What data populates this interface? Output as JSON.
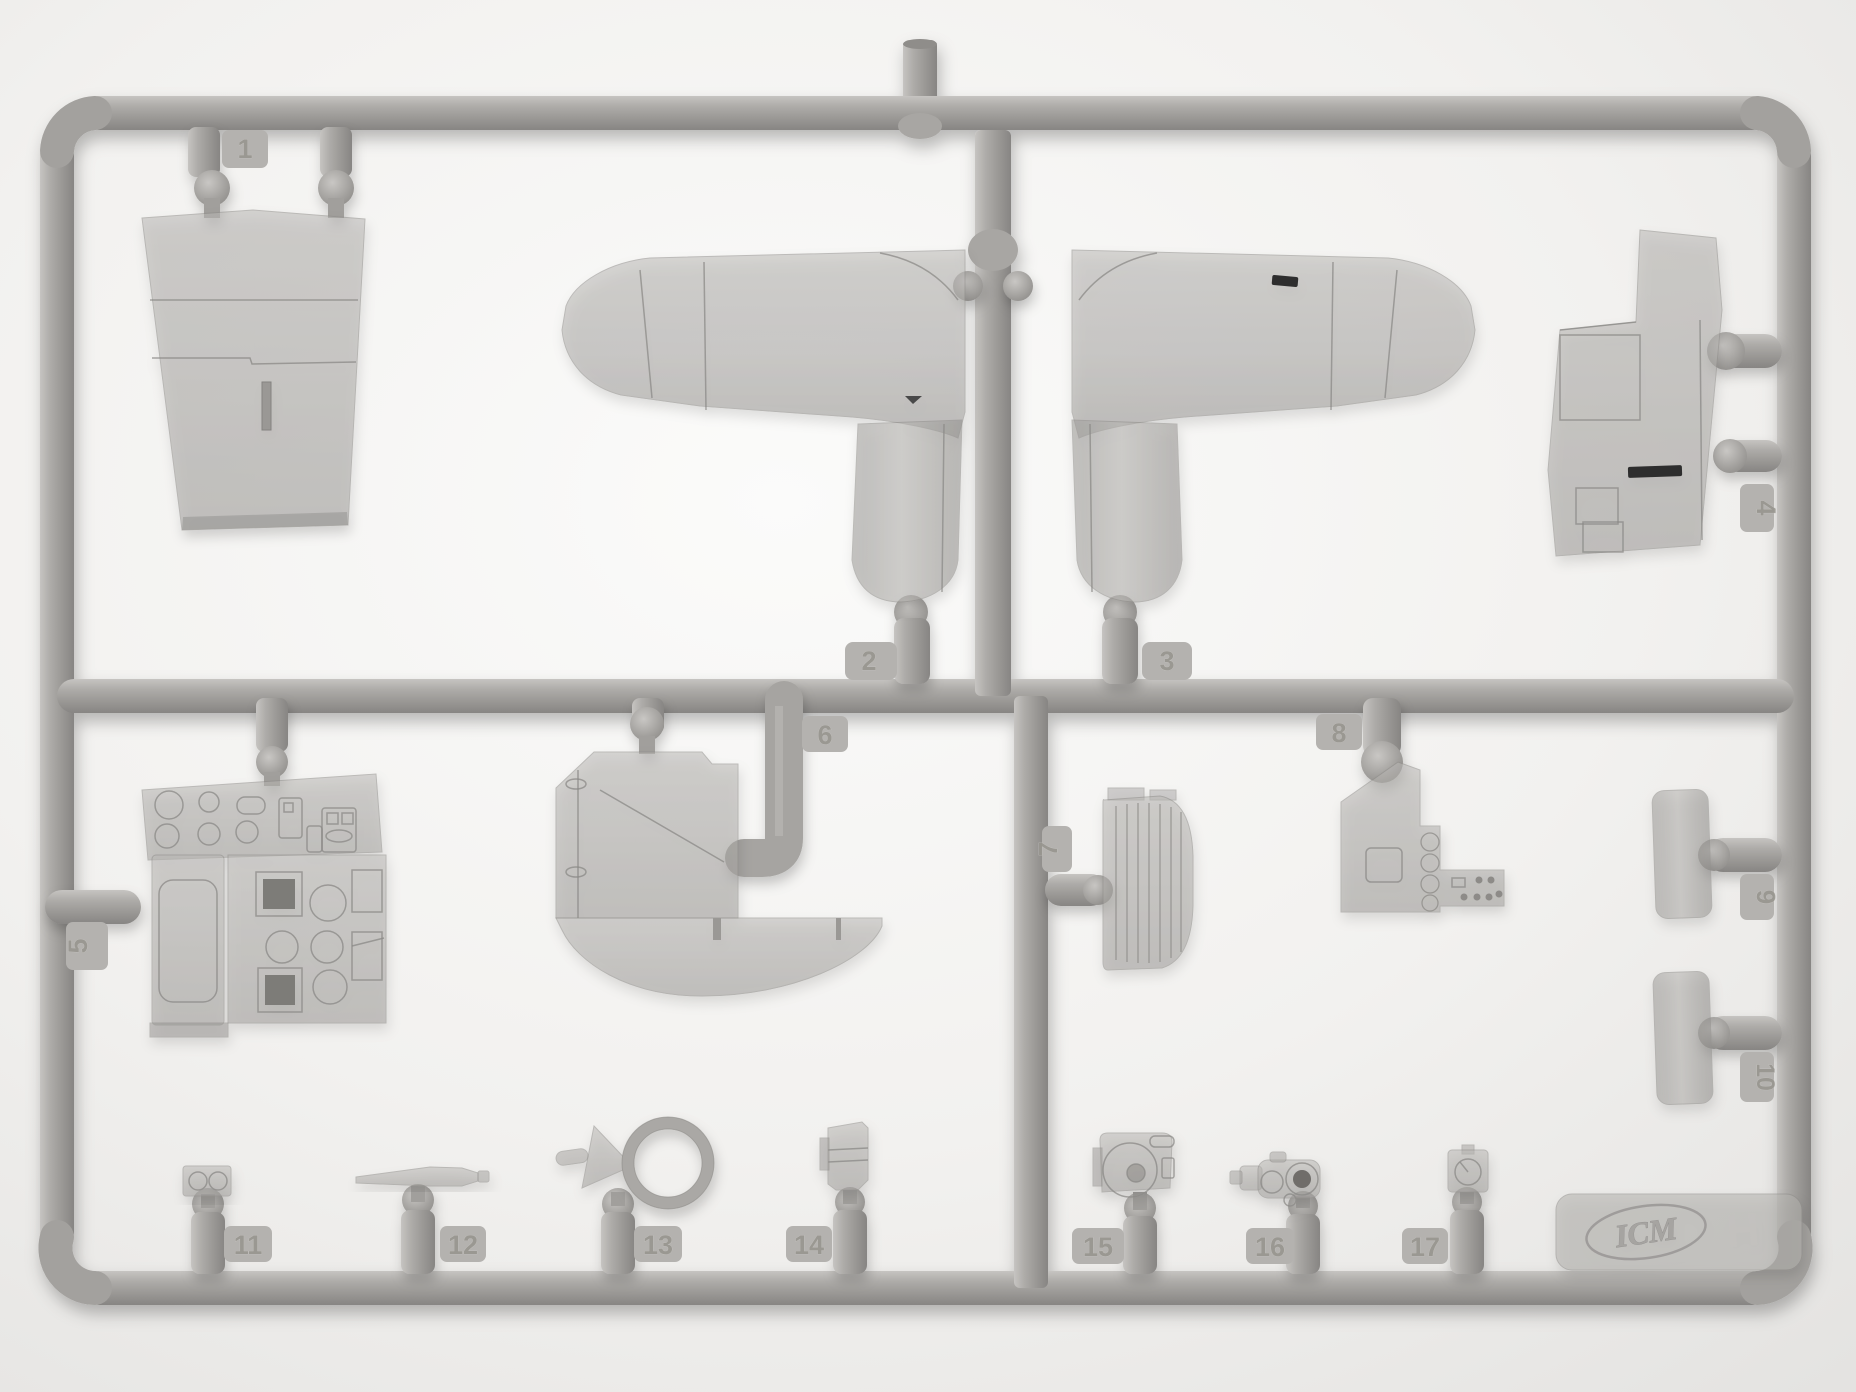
{
  "scene": {
    "description_colors": {
      "background": "#eeedeb",
      "plastic": "#aaa8a5",
      "plastic_highlight": "#c6c4c1",
      "plastic_shadow": "#8a8885",
      "dark_slot": "#2f2f2f"
    }
  },
  "sprue": {
    "part_count": 17,
    "tags": [
      "1",
      "2",
      "3",
      "4",
      "5",
      "6",
      "7",
      "8",
      "9",
      "10",
      "11",
      "12",
      "13",
      "14",
      "15",
      "16",
      "17"
    ],
    "logo_text": "ICM",
    "mold_letter": "H",
    "parts": [
      {
        "number": "1",
        "name": "tapered-fuselage-panel"
      },
      {
        "number": "2",
        "name": "wing-half-left-with-wheel-well"
      },
      {
        "number": "3",
        "name": "wing-half-right-with-wheel-well"
      },
      {
        "number": "4",
        "name": "stepped-fuselage-side-panel"
      },
      {
        "number": "5",
        "name": "instrument-panel-assembly"
      },
      {
        "number": "6",
        "name": "cockpit-floor-with-curved-bulkhead"
      },
      {
        "number": "7",
        "name": "ribbed-seat-back-panel"
      },
      {
        "number": "8",
        "name": "cockpit-side-console"
      },
      {
        "number": "9",
        "name": "curved-shroud-upper"
      },
      {
        "number": "10",
        "name": "curved-shroud-lower"
      },
      {
        "number": "11",
        "name": "twin-hole-bracket"
      },
      {
        "number": "12",
        "name": "tapered-gun-barrel-rod"
      },
      {
        "number": "13",
        "name": "ring-sight-with-funnel"
      },
      {
        "number": "14",
        "name": "small-clamp-bracket"
      },
      {
        "number": "15",
        "name": "gun-camera-box"
      },
      {
        "number": "16",
        "name": "small-gun-body"
      },
      {
        "number": "17",
        "name": "dial-instrument-box"
      }
    ]
  }
}
